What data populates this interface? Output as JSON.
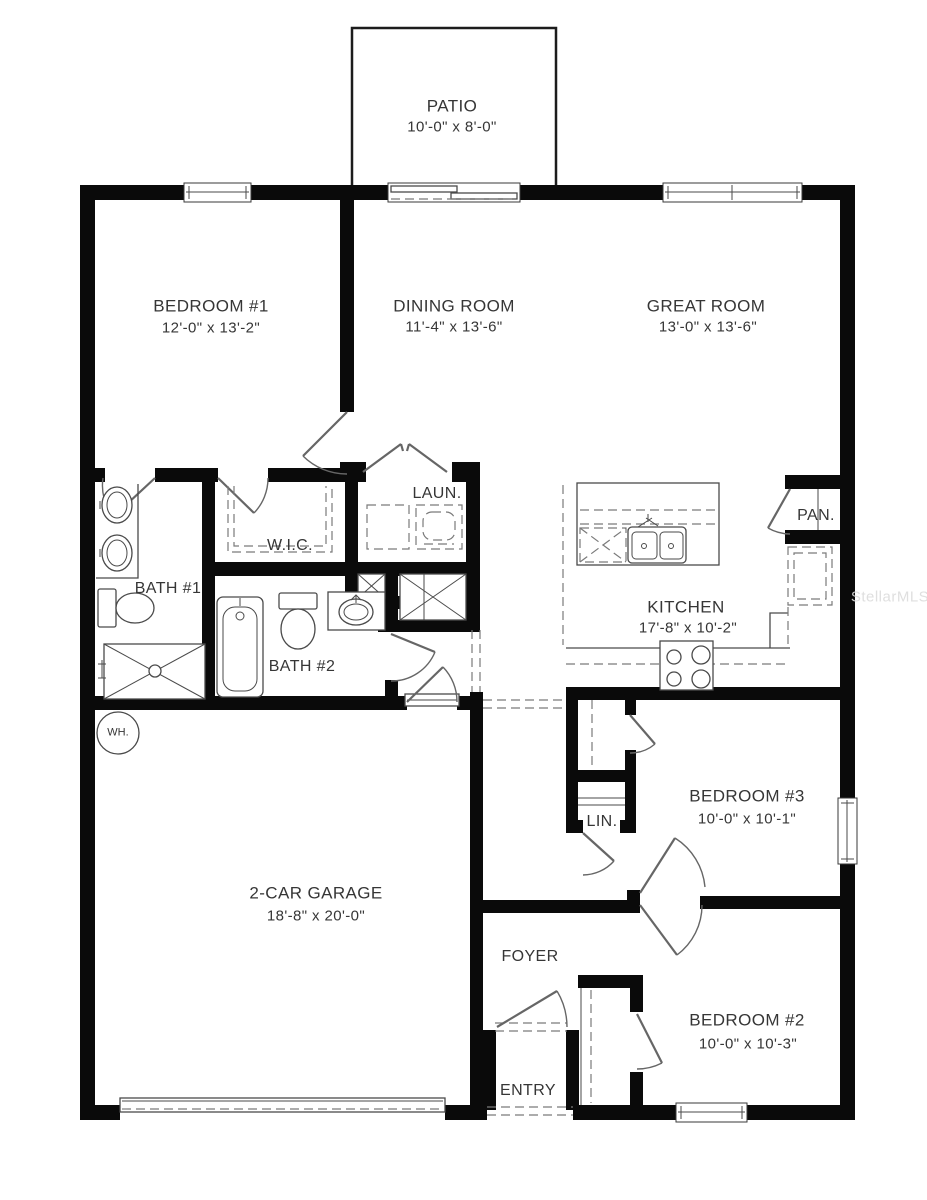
{
  "watermark": "StellarMLS",
  "colors": {
    "wall": "#0a0a0a",
    "line": "#4a4a4a",
    "text": "#363636",
    "watermark": "#dcdcdc",
    "background": "#ffffff"
  },
  "rooms": {
    "patio": {
      "name": "PATIO",
      "dims": "10'-0\" x 8'-0\""
    },
    "bedroom1": {
      "name": "BEDROOM #1",
      "dims": "12'-0\" x 13'-2\""
    },
    "dining": {
      "name": "DINING ROOM",
      "dims": "11'-4\" x 13'-6\""
    },
    "great": {
      "name": "GREAT ROOM",
      "dims": "13'-0\" x 13'-6\""
    },
    "laundry": {
      "name": "LAUN."
    },
    "wic": {
      "name": "W.I.C."
    },
    "bath1": {
      "name": "BATH #1"
    },
    "bath2": {
      "name": "BATH #2"
    },
    "pantry": {
      "name": "PAN."
    },
    "kitchen": {
      "name": "KITCHEN",
      "dims": "17'-8\" x 10'-2\""
    },
    "bedroom3": {
      "name": "BEDROOM #3",
      "dims": "10'-0\" x 10'-1\""
    },
    "linen": {
      "name": "LIN."
    },
    "garage": {
      "name": "2-CAR GARAGE",
      "dims": "18'-8\" x 20'-0\""
    },
    "foyer": {
      "name": "FOYER"
    },
    "entry": {
      "name": "ENTRY"
    },
    "bedroom2": {
      "name": "BEDROOM #2",
      "dims": "10'-0\" x 10'-3\""
    },
    "water_heater": {
      "name": "WH."
    }
  }
}
